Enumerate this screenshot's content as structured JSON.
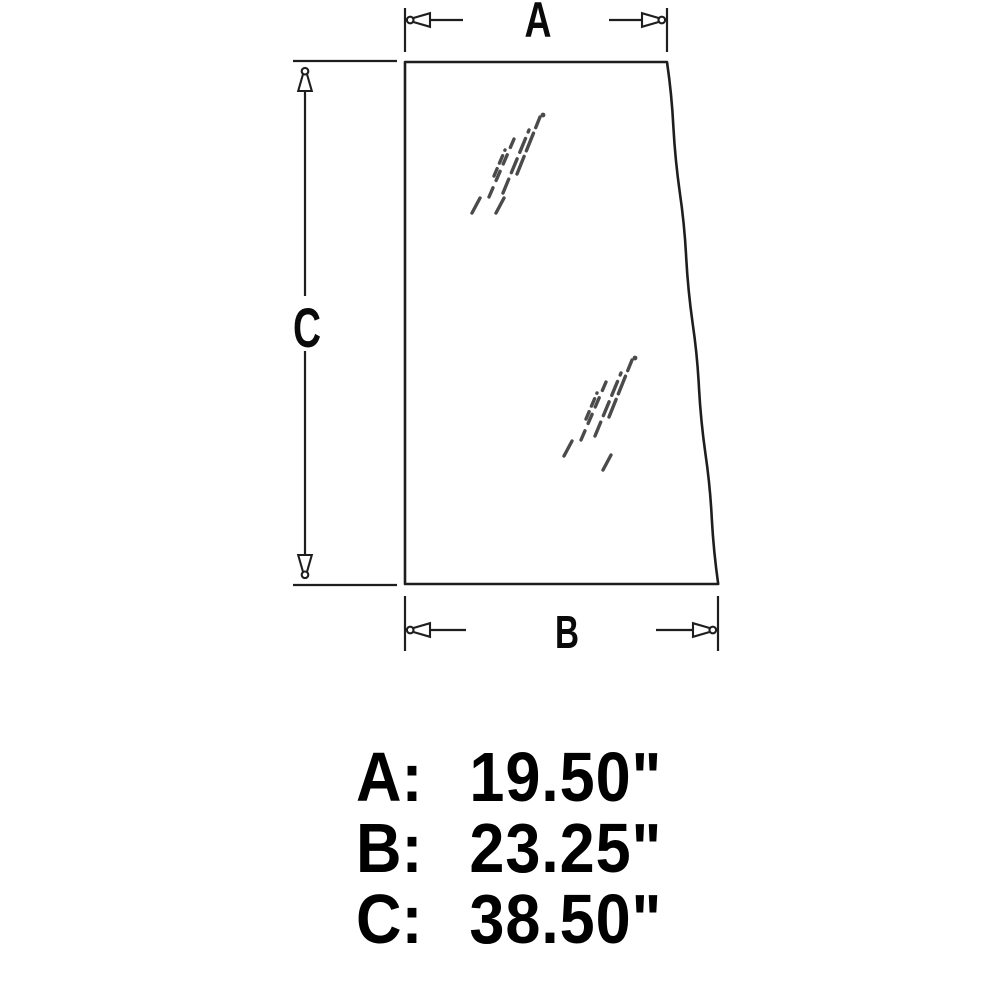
{
  "diagram": {
    "name": "glass-panel-dimension-drawing",
    "dimension_labels": {
      "a": "A",
      "b": "B",
      "c": "C"
    }
  },
  "measurements": {
    "rows": [
      {
        "label": "A:",
        "value": "19.50\""
      },
      {
        "label": "B:",
        "value": "23.25\""
      },
      {
        "label": "C:",
        "value": "38.50\""
      }
    ]
  },
  "colors": {
    "background": "#ffffff",
    "line": "#1e1e1e",
    "glare": "#4b4b4b",
    "text": "#000000"
  }
}
